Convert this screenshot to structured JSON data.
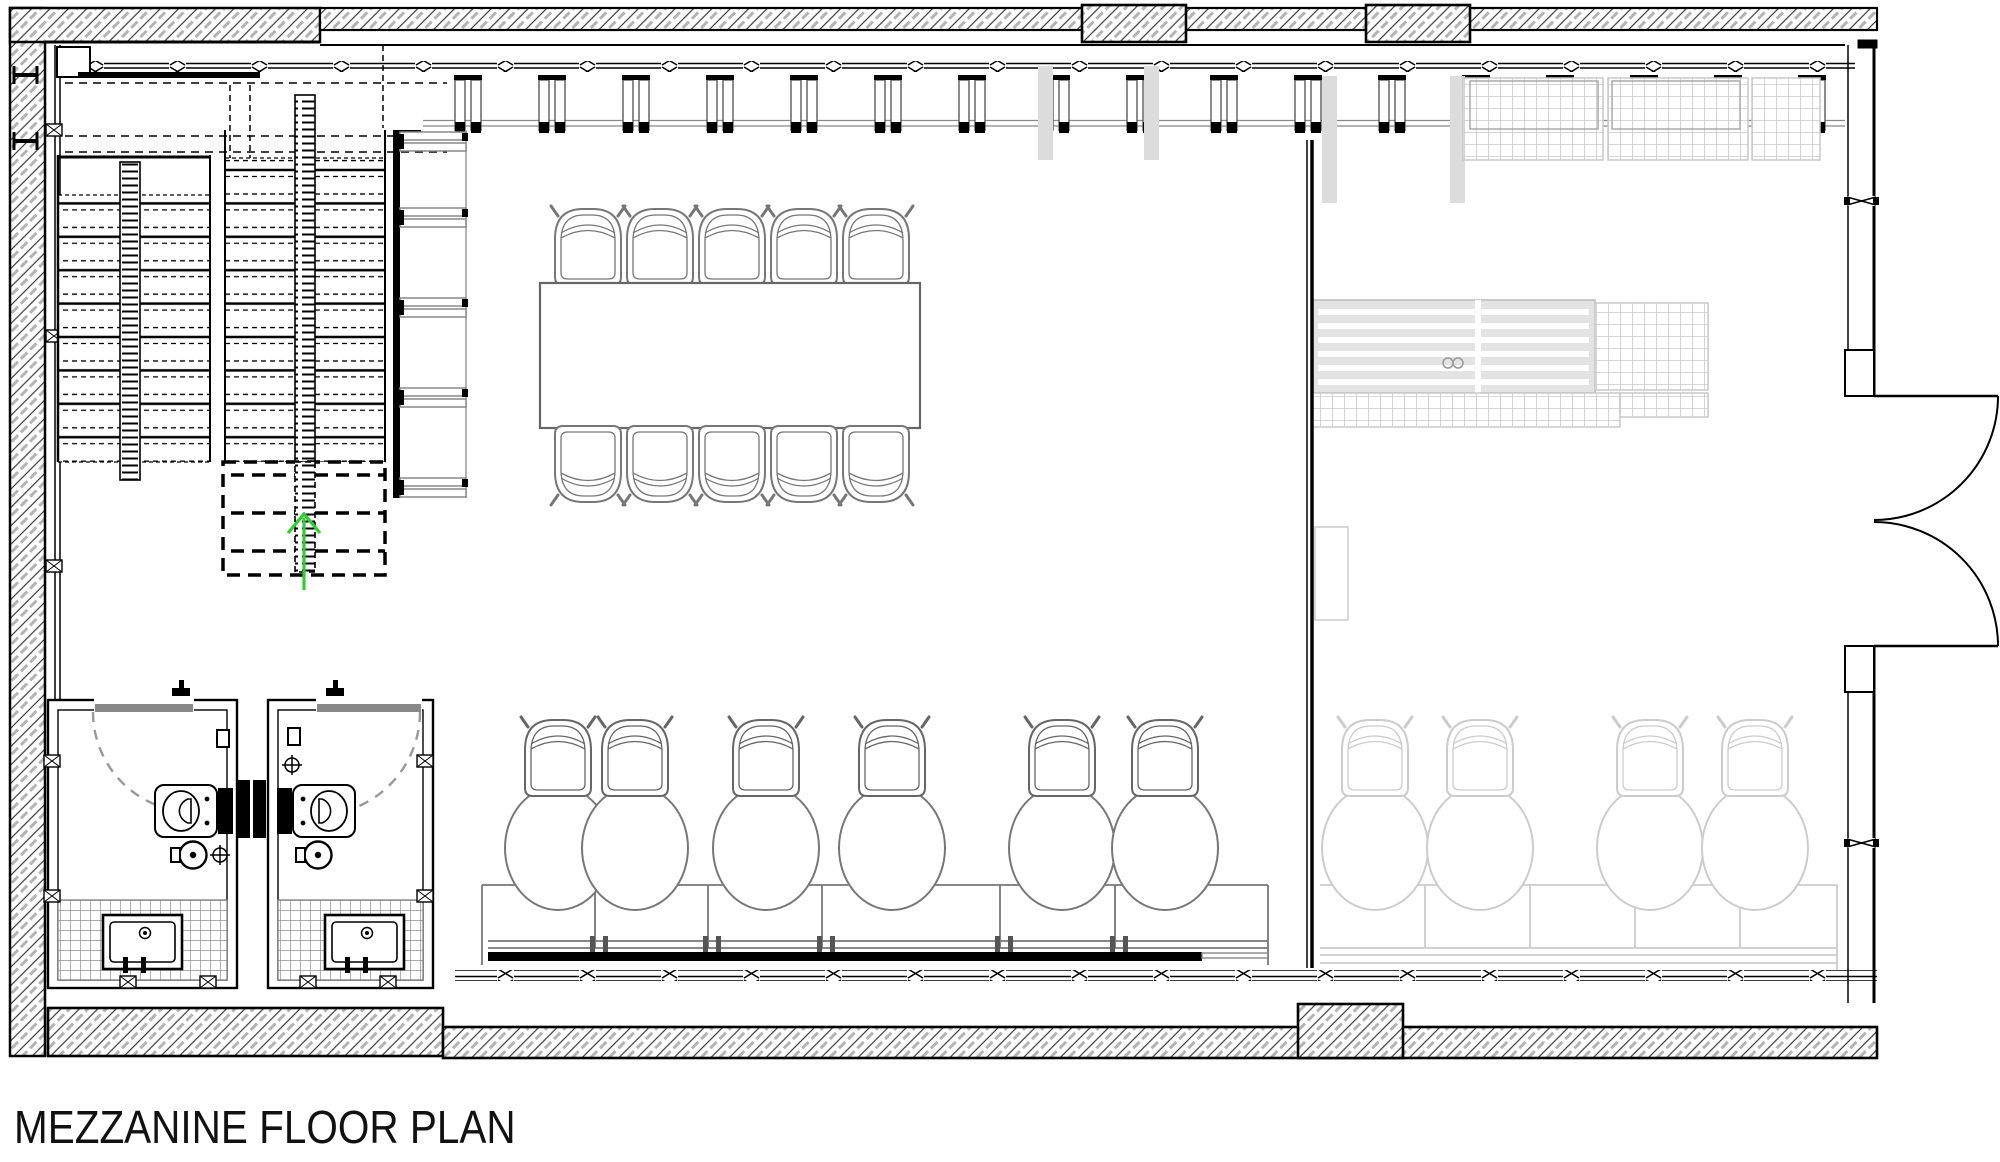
{
  "title": {
    "text": "MEZZANINE FLOOR PLAN"
  },
  "drawing": {
    "kind": "architectural plan, mezzanine level",
    "line_color": "#000000",
    "furniture_line_color": "#777777",
    "ghost_furniture_color": "#cccccc",
    "stair_arrow_color": "#33cc33",
    "rooms": {
      "stair_core": {
        "flights": 3,
        "direction_arrow": "up"
      },
      "meeting_area": {
        "conference_table_seats": 10
      },
      "workstation_row": {
        "task_chairs": 6,
        "desk_segments": 6
      },
      "ghost_workstation_row": {
        "task_chairs": 4
      },
      "wc_rooms": {
        "count": 2,
        "fixtures_per_room": [
          "toilet",
          "basin",
          "vanity-sink"
        ]
      },
      "ghost_kitchen": {
        "counters": 2,
        "cooktop": 1
      }
    },
    "openings": {
      "right_wall_double_door": {
        "leaves": 2,
        "swing": "outward"
      },
      "wc_doors": {
        "count": 2,
        "swing": "inward"
      }
    }
  }
}
